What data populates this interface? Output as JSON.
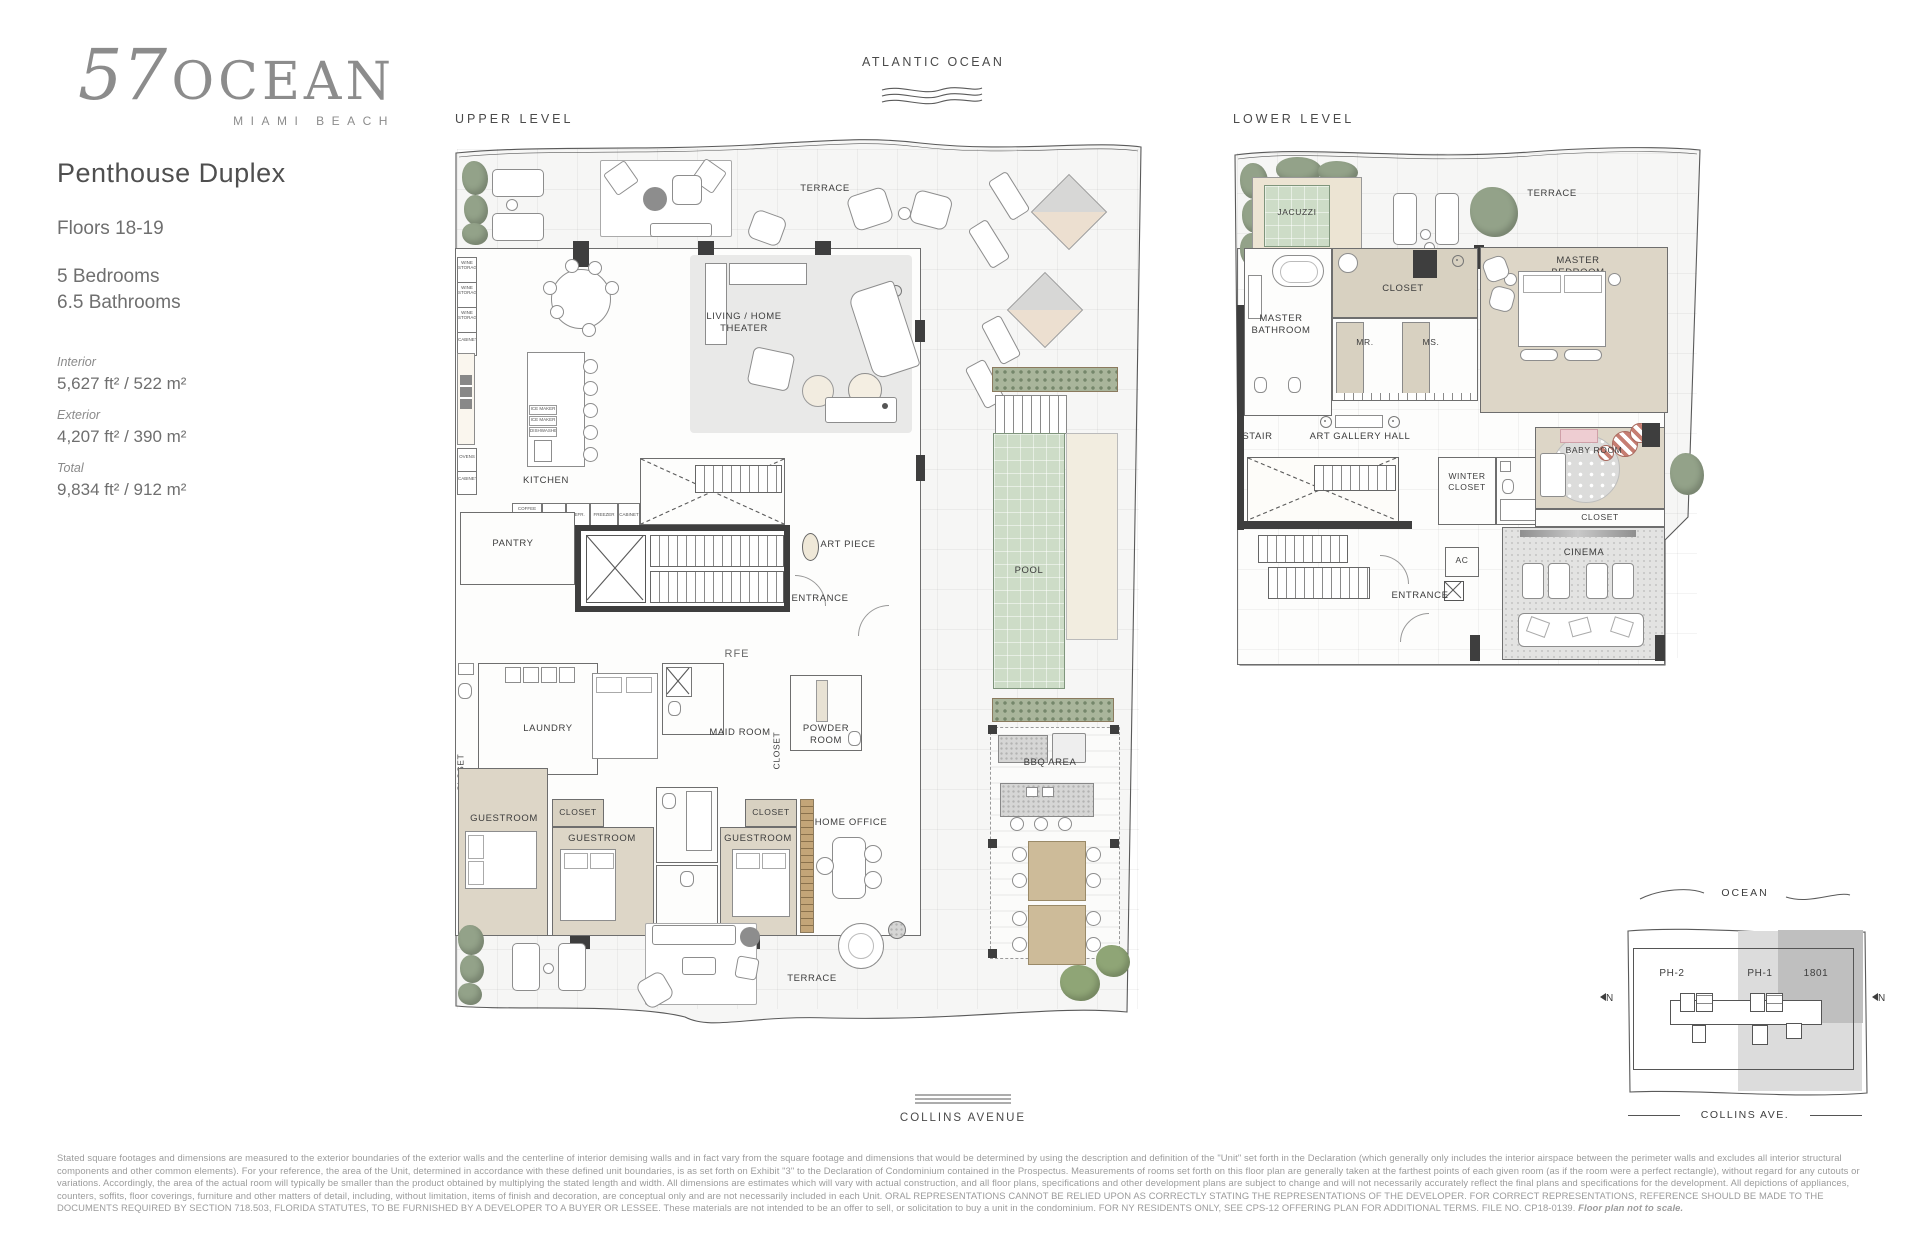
{
  "brand": {
    "number": "57",
    "name": "OCEAN",
    "subtitle": "MIAMI BEACH"
  },
  "unit": {
    "title": "Penthouse Duplex",
    "floors": "Floors 18-19",
    "bedrooms": "5 Bedrooms",
    "bathrooms": "6.5 Bathrooms",
    "areas": [
      {
        "label": "Interior",
        "value": "5,627 ft² / 522 m²"
      },
      {
        "label": "Exterior",
        "value": "4,207 ft² / 390 m²"
      },
      {
        "label": "Total",
        "value": "9,834 ft² / 912 m²"
      }
    ]
  },
  "context": {
    "ocean": "ATLANTIC OCEAN",
    "street": "COLLINS AVENUE"
  },
  "levels": {
    "upper": "UPPER LEVEL",
    "lower": "LOWER LEVEL"
  },
  "rooms": {
    "terrace": "TERRACE",
    "living": "LIVING / HOME THEATER",
    "kitchen": "KITCHEN",
    "pantry": "PANTRY",
    "art_piece": "ART PIECE",
    "entrance": "ENTRANCE",
    "rfe": "RFE",
    "laundry": "LAUNDRY",
    "maid_room": "MAID ROOM",
    "powder_room": "POWDER ROOM",
    "closet": "CLOSET",
    "guestroom": "GUESTROOM",
    "home_office": "HOME OFFICE",
    "pool": "POOL",
    "bbq": "BBQ AREA",
    "jacuzzi": "JACUZZI",
    "master_bathroom": "MASTER BATHROOM",
    "master_bedroom": "MASTER BEDROOM",
    "mr": "MR.",
    "ms": "MS.",
    "stair": "STAIR",
    "art_gallery": "ART GALLERY HALL",
    "winter_closet": "WINTER CLOSET",
    "baby_room": "BABY ROOM",
    "cinema": "CINEMA",
    "ac": "AC"
  },
  "appliances": {
    "wine": "WINE STORAGE",
    "cabinet": "CABINET",
    "ovens": "OVENS",
    "coffee": "COFFEE MACHINE MICROWAVE",
    "refr": "REFR.",
    "freezer": "FREEZER",
    "ice": "ICE MAKER",
    "dw": "DISHWASHER"
  },
  "key_plan": {
    "ocean": "OCEAN",
    "ph2": "PH-2",
    "ph1": "PH-1",
    "unit_1801": "1801",
    "street": "COLLINS AVE.",
    "north": "N"
  },
  "disclaimer": {
    "text": "Stated square footages and dimensions are measured to the exterior boundaries of the exterior walls and the centerline of interior demising walls and in fact vary from the square footage and dimensions that would be determined by using the description and definition of the \"Unit\" set forth in the Declaration (which generally only includes the interior airspace between the perimeter walls and excludes all interior structural components and other common elements). For your reference, the area of the Unit, determined in accordance with these defined unit boundaries, is as set forth on Exhibit \"3\" to the Declaration of Condominium contained in the Prospectus. Measurements of rooms set forth on this floor plan are generally taken at the farthest points of each given room (as if the room were a perfect rectangle), without regard for any cutouts or variations. Accordingly, the area of the actual room will typically be smaller than the product obtained by multiplying the stated length and width. All dimensions are estimates which will vary with actual construction, and all floor plans, specifications and other development plans are subject to change and will not necessarily accurately reflect the final plans and specifications for the development. All depictions of appliances, counters, soffits, floor coverings, furniture and other matters of detail, including, without limitation, items of finish and decoration, are conceptual only and are not necessarily included in each Unit. ORAL REPRESENTATIONS CANNOT BE RELIED UPON AS CORRECTLY STATING THE REPRESENTATIONS OF THE DEVELOPER. FOR CORRECT REPRESENTATIONS, REFERENCE SHOULD BE MADE TO THE DOCUMENTS REQUIRED BY SECTION 718.503, FLORIDA STATUTES, TO BE FURNISHED BY A DEVELOPER TO A BUYER OR LESSEE. These materials are not intended to be an offer to sell, or solicitation to buy a unit in the condominium. FOR NY RESIDENTS ONLY, SEE CPS-12 OFFERING PLAN FOR ADDITIONAL TERMS. FILE NO. CP18-0139. ",
    "note": "Floor plan not to scale."
  }
}
